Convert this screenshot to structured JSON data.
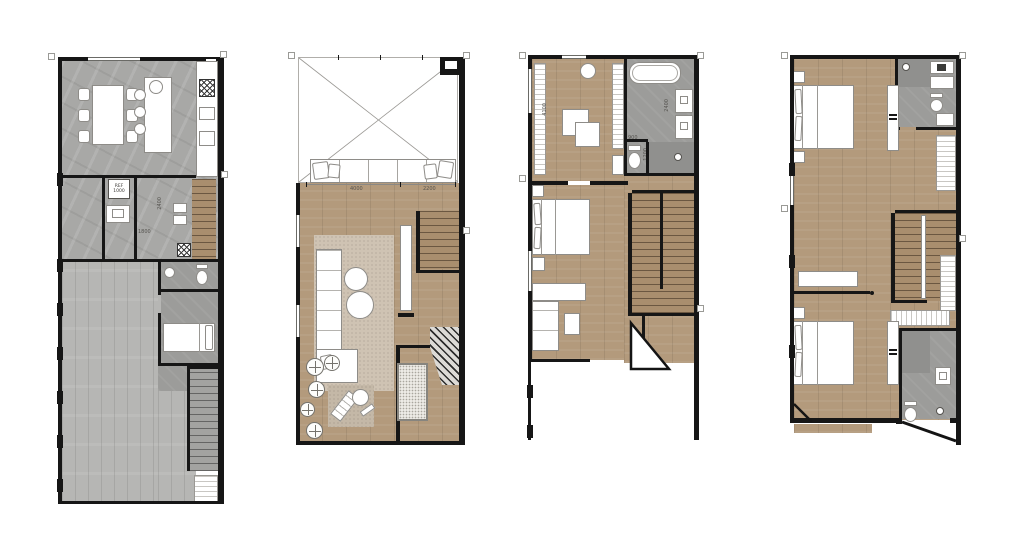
{
  "canvas": {
    "width": 1024,
    "height": 539,
    "background": "#ffffff"
  },
  "colors": {
    "wall": "#161616",
    "marble_floor": "#a8a8a6",
    "wood_floor": "#b39a7c",
    "deck_floor": "#b6b6b4",
    "tile_floor": "#9c9c9a",
    "stair_wood": "#a98e6e",
    "rug": "#cfc3b3",
    "dimension_text": "#55534f"
  },
  "plans": [
    {
      "name": "ground-floor-plan",
      "labels": {
        "ref_line1": "REF",
        "ref_line2": "1000",
        "dim_vertical": "2400",
        "dim_horizontal": "1800"
      }
    },
    {
      "name": "living-floor-plan",
      "labels": {
        "dim_left": "4000",
        "dim_right": "2200"
      }
    },
    {
      "name": "bedroom-floor-plan-a",
      "labels": {
        "dim_room": "4100",
        "dim_bath": "2400",
        "dim_wc_width": "900",
        "dim_wc_depth": "1200"
      }
    },
    {
      "name": "bedroom-floor-plan-b",
      "labels": {}
    }
  ]
}
